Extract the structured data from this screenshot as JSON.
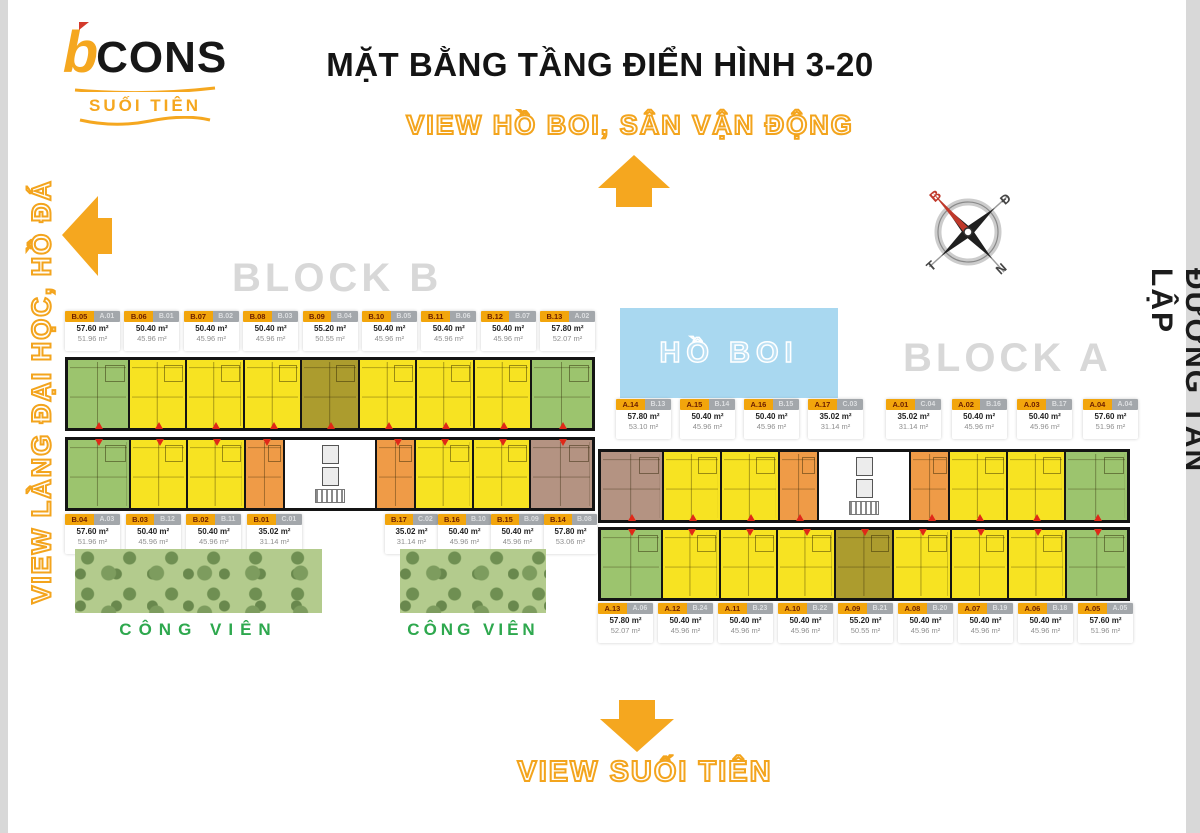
{
  "logo": {
    "brand_b": "b",
    "brand_rest": "CONS",
    "subtitle": "SUỐI TIÊN"
  },
  "texts": {
    "title": "MẶT BẰNG TẦNG ĐIỂN HÌNH 3-20",
    "view_top": "VIEW HỒ BOI, SÂN VẬN ĐỘNG",
    "view_left": "VIEW LÀNG ĐẠI HỌC, HỒ ĐÁ",
    "view_bottom": "VIEW SUỐI TIÊN",
    "road_right": "ĐƯỜNG TÂN LẬP",
    "block_a": "BLOCK A",
    "block_b": "BLOCK B",
    "pool": "HỒ BOI",
    "park": "CÔNG VIÊN"
  },
  "compass": {
    "north": "B",
    "east": "Đ",
    "south": "N",
    "west": "T"
  },
  "colors": {
    "accent_orange": "#F5A71F",
    "unit_yellow": "#F7E322",
    "unit_green": "#9CC46E",
    "unit_olive": "#AC9C2E",
    "unit_orange": "#EF9B47",
    "unit_brown": "#B49382",
    "pool_blue": "#A9D8F0",
    "park_green": "#B3CB8D",
    "block_label_gray": "#D8D8D8",
    "park_text_green": "#2EA84E",
    "entry_red": "#E02818",
    "badge_orange": "#F2A50C",
    "badge_gray": "#A3A7AB"
  },
  "block_b": {
    "top_labels": [
      {
        "unit": "B.05",
        "alt": "A.01",
        "area": "57.60 m²",
        "carpet": "51.96 m²"
      },
      {
        "unit": "B.06",
        "alt": "B.01",
        "area": "50.40 m²",
        "carpet": "45.96 m²"
      },
      {
        "unit": "B.07",
        "alt": "B.02",
        "area": "50.40 m²",
        "carpet": "45.96 m²"
      },
      {
        "unit": "B.08",
        "alt": "B.03",
        "area": "50.40 m²",
        "carpet": "45.96 m²"
      },
      {
        "unit": "B.09",
        "alt": "B.04",
        "area": "55.20 m²",
        "carpet": "50.55 m²"
      },
      {
        "unit": "B.10",
        "alt": "B.05",
        "area": "50.40 m²",
        "carpet": "45.96 m²"
      },
      {
        "unit": "B.11",
        "alt": "B.06",
        "area": "50.40 m²",
        "carpet": "45.96 m²"
      },
      {
        "unit": "B.12",
        "alt": "B.07",
        "area": "50.40 m²",
        "carpet": "45.96 m²"
      },
      {
        "unit": "B.13",
        "alt": "A.02",
        "area": "57.80 m²",
        "carpet": "52.07 m²"
      }
    ],
    "bottom_labels_left": [
      {
        "unit": "B.04",
        "alt": "A.03",
        "area": "57.60 m²",
        "carpet": "51.96 m²"
      },
      {
        "unit": "B.03",
        "alt": "B.12",
        "area": "50.40 m²",
        "carpet": "45.96 m²"
      },
      {
        "unit": "B.02",
        "alt": "B.11",
        "area": "50.40 m²",
        "carpet": "45.96 m²"
      },
      {
        "unit": "B.01",
        "alt": "C.01",
        "area": "35.02 m²",
        "carpet": "31.14 m²"
      }
    ],
    "bottom_labels_right": [
      {
        "unit": "B.17",
        "alt": "C.02",
        "area": "35.02 m²",
        "carpet": "31.14 m²"
      },
      {
        "unit": "B.16",
        "alt": "B.10",
        "area": "50.40 m²",
        "carpet": "45.96 m²"
      },
      {
        "unit": "B.15",
        "alt": "B.09",
        "area": "50.40 m²",
        "carpet": "45.96 m²"
      },
      {
        "unit": "B.14",
        "alt": "B.08",
        "area": "57.80 m²",
        "carpet": "53.06 m²"
      }
    ],
    "row1_units": [
      {
        "unit": "B.05",
        "fill": "green"
      },
      {
        "unit": "B.06",
        "fill": "yellow"
      },
      {
        "unit": "B.07",
        "fill": "yellow"
      },
      {
        "unit": "B.08",
        "fill": "yellow"
      },
      {
        "unit": "B.09",
        "fill": "olive"
      },
      {
        "unit": "B.10",
        "fill": "yellow"
      },
      {
        "unit": "B.11",
        "fill": "yellow"
      },
      {
        "unit": "B.12",
        "fill": "yellow"
      },
      {
        "unit": "B.13",
        "fill": "green"
      }
    ],
    "row2_units": [
      {
        "unit": "B.04",
        "fill": "green"
      },
      {
        "unit": "B.03",
        "fill": "yellow"
      },
      {
        "unit": "B.02",
        "fill": "yellow"
      },
      {
        "unit": "B.01",
        "fill": "orange"
      },
      {
        "unit": "core",
        "fill": "core"
      },
      {
        "unit": "B.17",
        "fill": "orange"
      },
      {
        "unit": "B.16",
        "fill": "yellow"
      },
      {
        "unit": "B.15",
        "fill": "yellow"
      },
      {
        "unit": "B.14",
        "fill": "brown"
      }
    ]
  },
  "block_a": {
    "mid_labels_left": [
      {
        "unit": "A.14",
        "alt": "B.13",
        "area": "57.80 m²",
        "carpet": "53.10 m²"
      },
      {
        "unit": "A.15",
        "alt": "B.14",
        "area": "50.40 m²",
        "carpet": "45.96 m²"
      },
      {
        "unit": "A.16",
        "alt": "B.15",
        "area": "50.40 m²",
        "carpet": "45.96 m²"
      },
      {
        "unit": "A.17",
        "alt": "C.03",
        "area": "35.02 m²",
        "carpet": "31.14 m²"
      }
    ],
    "mid_labels_right": [
      {
        "unit": "A.01",
        "alt": "C.04",
        "area": "35.02 m²",
        "carpet": "31.14 m²"
      },
      {
        "unit": "A.02",
        "alt": "B.16",
        "area": "50.40 m²",
        "carpet": "45.96 m²"
      },
      {
        "unit": "A.03",
        "alt": "B.17",
        "area": "50.40 m²",
        "carpet": "45.96 m²"
      },
      {
        "unit": "A.04",
        "alt": "A.04",
        "area": "57.60 m²",
        "carpet": "51.96 m²"
      }
    ],
    "bottom_labels": [
      {
        "unit": "A.13",
        "alt": "A.06",
        "area": "57.80 m²",
        "carpet": "52.07 m²"
      },
      {
        "unit": "A.12",
        "alt": "B.24",
        "area": "50.40 m²",
        "carpet": "45.96 m²"
      },
      {
        "unit": "A.11",
        "alt": "B.23",
        "area": "50.40 m²",
        "carpet": "45.96 m²"
      },
      {
        "unit": "A.10",
        "alt": "B.22",
        "area": "50.40 m²",
        "carpet": "45.96 m²"
      },
      {
        "unit": "A.09",
        "alt": "B.21",
        "area": "55.20 m²",
        "carpet": "50.55 m²"
      },
      {
        "unit": "A.08",
        "alt": "B.20",
        "area": "50.40 m²",
        "carpet": "45.96 m²"
      },
      {
        "unit": "A.07",
        "alt": "B.19",
        "area": "50.40 m²",
        "carpet": "45.96 m²"
      },
      {
        "unit": "A.06",
        "alt": "B.18",
        "area": "50.40 m²",
        "carpet": "45.96 m²"
      },
      {
        "unit": "A.05",
        "alt": "A.05",
        "area": "57.60 m²",
        "carpet": "51.96 m²"
      }
    ],
    "row1_units": [
      {
        "unit": "A.14",
        "fill": "brown"
      },
      {
        "unit": "A.15",
        "fill": "yellow"
      },
      {
        "unit": "A.16",
        "fill": "yellow"
      },
      {
        "unit": "A.17",
        "fill": "orange"
      },
      {
        "unit": "core",
        "fill": "core"
      },
      {
        "unit": "A.01",
        "fill": "orange"
      },
      {
        "unit": "A.02",
        "fill": "yellow"
      },
      {
        "unit": "A.03",
        "fill": "yellow"
      },
      {
        "unit": "A.04",
        "fill": "green"
      }
    ],
    "row2_units": [
      {
        "unit": "A.13",
        "fill": "green"
      },
      {
        "unit": "A.12",
        "fill": "yellow"
      },
      {
        "unit": "A.11",
        "fill": "yellow"
      },
      {
        "unit": "A.10",
        "fill": "yellow"
      },
      {
        "unit": "A.09",
        "fill": "olive"
      },
      {
        "unit": "A.08",
        "fill": "yellow"
      },
      {
        "unit": "A.07",
        "fill": "yellow"
      },
      {
        "unit": "A.06",
        "fill": "yellow"
      },
      {
        "unit": "A.05",
        "fill": "green"
      }
    ]
  }
}
